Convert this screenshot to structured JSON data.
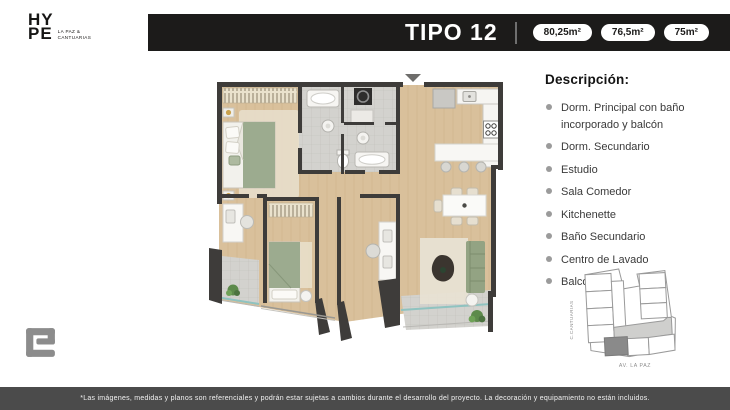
{
  "brand": {
    "line1": "HY",
    "line2": "PE",
    "sub_line1": "LA PAZ &",
    "sub_line2": "CANTUARIAS"
  },
  "header": {
    "title": "TIPO 12",
    "badges": [
      "80,25m²",
      "76,5m²",
      "75m²"
    ]
  },
  "description": {
    "title": "Descripción:",
    "items": [
      "Dorm. Principal con baño incorporado y balcón",
      "Dorm. Secundario",
      "Estudio",
      "Sala Comedor",
      "Kitchenette",
      "Baño Secundario",
      "Centro de Lavado",
      "Balcón"
    ]
  },
  "minimap": {
    "street_left": "C.CANTUARIAS",
    "street_bottom": "AV. LA PAZ"
  },
  "footer": {
    "disclaimer": "*Las imágenes, medidas y planos son referenciales y podrán estar sujetas a cambios durante el desarrollo del proyecto. La decoración y equipamiento no están incluidos."
  },
  "colors": {
    "header_bar": "#1c1b1a",
    "footer_bar": "#4b4b4b",
    "wood_floor": "#d9c09b",
    "wall": "#3e3c3a",
    "furniture_green": "#9cab8f",
    "bath_tile": "#d3d2ce",
    "balcony_glass": "#8fc3c0",
    "bullet": "#9b9b9b",
    "map_highlight": "#8a8a8a"
  }
}
